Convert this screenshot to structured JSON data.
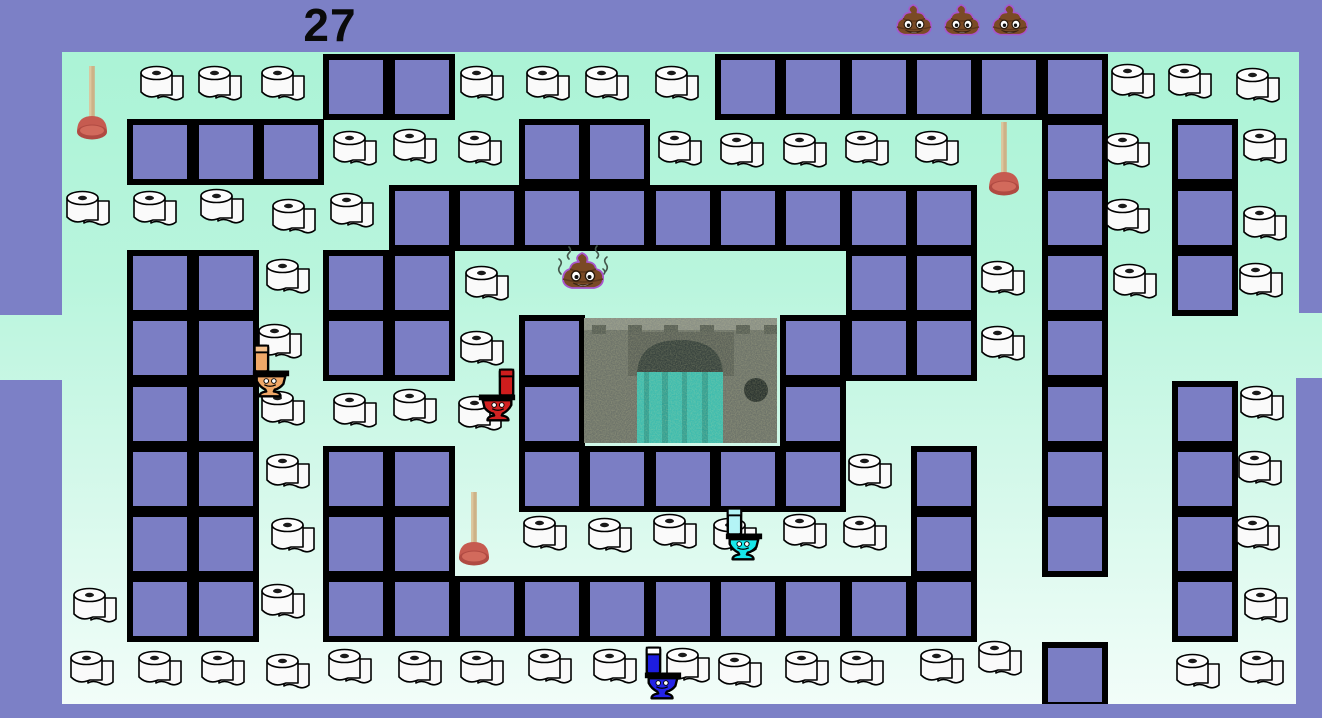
{
  "hud": {
    "score": "27",
    "lives_count": 3,
    "lives_icon": "poop-emoji"
  },
  "colors": {
    "frame_purple": "#7c80c6",
    "wall_purple": "#7b7ec4",
    "wall_border": "#000000",
    "mint_top": "#abf3d6",
    "mint_bottom": "#f2fdf9",
    "paper_white": "#fafafa",
    "plunger_cup": "#c65b50",
    "plunger_handle": "#cdb287",
    "poop_brown": "#7a4a25",
    "poop_outline": "#a855cc",
    "house_base": "#6e746a",
    "house_arch": "#39443f",
    "house_water": "#3fbcae",
    "toilet_orange": "#f0a868",
    "toilet_red": "#d42222",
    "toilet_cyan": "#17e7ea",
    "toilet_blue": "#2424e8"
  },
  "maze": {
    "origin_x": 62,
    "origin_y": 54,
    "cell": 65.3,
    "tunnel_row": 4,
    "walls": [
      [
        4,
        0
      ],
      [
        5,
        0
      ],
      [
        10,
        0
      ],
      [
        11,
        0
      ],
      [
        12,
        0
      ],
      [
        13,
        0
      ],
      [
        14,
        0
      ],
      [
        15,
        0
      ],
      [
        1,
        1
      ],
      [
        2,
        1
      ],
      [
        3,
        1
      ],
      [
        7,
        1
      ],
      [
        8,
        1
      ],
      [
        15,
        1
      ],
      [
        17,
        1
      ],
      [
        5,
        2
      ],
      [
        6,
        2
      ],
      [
        7,
        2
      ],
      [
        8,
        2
      ],
      [
        9,
        2
      ],
      [
        10,
        2
      ],
      [
        11,
        2
      ],
      [
        12,
        2
      ],
      [
        13,
        2
      ],
      [
        15,
        2
      ],
      [
        17,
        2
      ],
      [
        1,
        3
      ],
      [
        2,
        3
      ],
      [
        4,
        3
      ],
      [
        5,
        3
      ],
      [
        12,
        3
      ],
      [
        13,
        3
      ],
      [
        15,
        3
      ],
      [
        17,
        3
      ],
      [
        1,
        4
      ],
      [
        2,
        4
      ],
      [
        4,
        4
      ],
      [
        5,
        4
      ],
      [
        7,
        4
      ],
      [
        11,
        4
      ],
      [
        12,
        4
      ],
      [
        13,
        4
      ],
      [
        15,
        4
      ],
      [
        1,
        5
      ],
      [
        2,
        5
      ],
      [
        7,
        5
      ],
      [
        11,
        5
      ],
      [
        15,
        5
      ],
      [
        17,
        5
      ],
      [
        1,
        6
      ],
      [
        2,
        6
      ],
      [
        4,
        6
      ],
      [
        5,
        6
      ],
      [
        7,
        6
      ],
      [
        8,
        6
      ],
      [
        9,
        6
      ],
      [
        10,
        6
      ],
      [
        11,
        6
      ],
      [
        13,
        6
      ],
      [
        15,
        6
      ],
      [
        17,
        6
      ],
      [
        1,
        7
      ],
      [
        2,
        7
      ],
      [
        4,
        7
      ],
      [
        5,
        7
      ],
      [
        13,
        7
      ],
      [
        15,
        7
      ],
      [
        17,
        7
      ],
      [
        1,
        8
      ],
      [
        2,
        8
      ],
      [
        4,
        8
      ],
      [
        5,
        8
      ],
      [
        6,
        8
      ],
      [
        7,
        8
      ],
      [
        8,
        8
      ],
      [
        9,
        8
      ],
      [
        10,
        8
      ],
      [
        11,
        8
      ],
      [
        12,
        8
      ],
      [
        13,
        8
      ],
      [
        17,
        8
      ],
      [
        15,
        9
      ]
    ],
    "margins": {
      "left": [
        {
          "x": 0,
          "y": 52,
          "w": 62,
          "h": 263
        },
        {
          "x": 0,
          "y": 380,
          "w": 62,
          "h": 324
        }
      ],
      "right": [
        {
          "x": 1299,
          "y": 52,
          "w": 23,
          "h": 261
        },
        {
          "x": 1296,
          "y": 378,
          "w": 26,
          "h": 326
        }
      ]
    }
  },
  "pellets": [
    [
      162,
      85
    ],
    [
      220,
      85
    ],
    [
      283,
      85
    ],
    [
      482,
      85
    ],
    [
      548,
      85
    ],
    [
      607,
      85
    ],
    [
      677,
      85
    ],
    [
      1133,
      83
    ],
    [
      1190,
      83
    ],
    [
      1258,
      87
    ],
    [
      355,
      150
    ],
    [
      415,
      148
    ],
    [
      480,
      150
    ],
    [
      680,
      150
    ],
    [
      742,
      152
    ],
    [
      805,
      152
    ],
    [
      867,
      150
    ],
    [
      937,
      150
    ],
    [
      1128,
      152
    ],
    [
      1265,
      148
    ],
    [
      88,
      210
    ],
    [
      155,
      210
    ],
    [
      222,
      208
    ],
    [
      294,
      218
    ],
    [
      352,
      212
    ],
    [
      1128,
      218
    ],
    [
      1265,
      225
    ],
    [
      288,
      278
    ],
    [
      487,
      285
    ],
    [
      1003,
      280
    ],
    [
      1135,
      283
    ],
    [
      1261,
      282
    ],
    [
      280,
      343
    ],
    [
      482,
      350
    ],
    [
      1003,
      345
    ],
    [
      283,
      410
    ],
    [
      355,
      412
    ],
    [
      415,
      408
    ],
    [
      480,
      415
    ],
    [
      1262,
      405
    ],
    [
      288,
      473
    ],
    [
      870,
      473
    ],
    [
      1260,
      470
    ],
    [
      293,
      537
    ],
    [
      545,
      535
    ],
    [
      610,
      537
    ],
    [
      675,
      533
    ],
    [
      735,
      537
    ],
    [
      805,
      533
    ],
    [
      865,
      535
    ],
    [
      1258,
      535
    ],
    [
      95,
      607
    ],
    [
      283,
      603
    ],
    [
      1266,
      607
    ],
    [
      92,
      670
    ],
    [
      160,
      670
    ],
    [
      223,
      670
    ],
    [
      288,
      673
    ],
    [
      350,
      668
    ],
    [
      420,
      670
    ],
    [
      482,
      670
    ],
    [
      550,
      668
    ],
    [
      615,
      668
    ],
    [
      688,
      667
    ],
    [
      740,
      672
    ],
    [
      807,
      670
    ],
    [
      862,
      670
    ],
    [
      942,
      668
    ],
    [
      1000,
      660
    ],
    [
      1198,
      673
    ],
    [
      1262,
      670
    ]
  ],
  "plungers": [
    {
      "x": 74,
      "y": 64
    },
    {
      "x": 986,
      "y": 120
    },
    {
      "x": 456,
      "y": 490
    }
  ],
  "ghost_house": {
    "x": 584,
    "y": 318,
    "w": 193,
    "h": 125
  },
  "characters": {
    "player": {
      "type": "poop",
      "x": 583,
      "y": 269
    },
    "enemies": [
      {
        "name": "orange-toilet",
        "x": 250,
        "y": 342,
        "facing": "right",
        "tank": "#f0a868",
        "cap": "#f7c28e",
        "bowl": "#f0a868"
      },
      {
        "name": "red-toilet",
        "x": 476,
        "y": 366,
        "facing": "left",
        "tank": "#cf1d1d",
        "cap": "#cf1d1d",
        "bowl": "#d42222"
      },
      {
        "name": "cyan-toilet",
        "x": 723,
        "y": 505,
        "facing": "right",
        "tank": "#b4f4f6",
        "cap": "#b4f4f6",
        "bowl": "#17e7ea"
      },
      {
        "name": "blue-toilet",
        "x": 642,
        "y": 644,
        "facing": "right",
        "tank": "#1d1de0",
        "cap": "#ffffff",
        "bowl": "#2424e8"
      }
    ]
  }
}
